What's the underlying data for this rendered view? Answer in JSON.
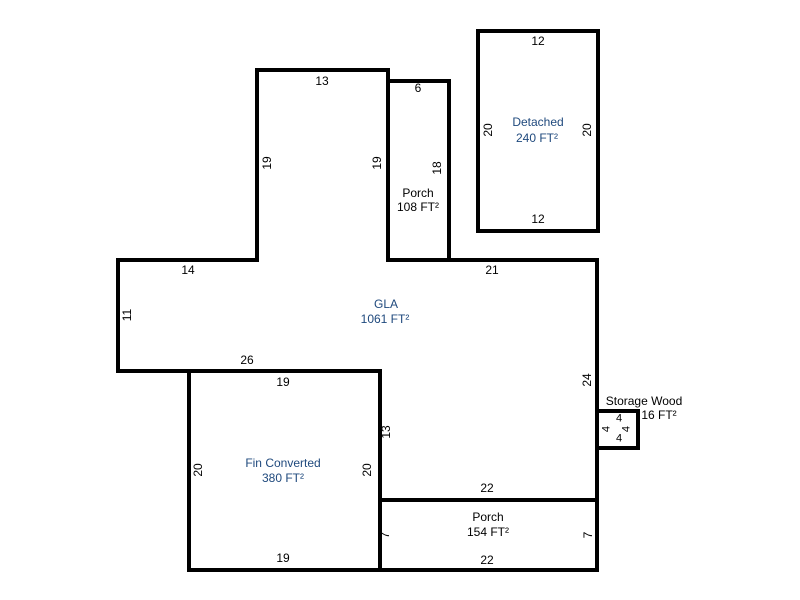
{
  "sketch": {
    "type": "floor-plan",
    "units": "FT",
    "scale_px_per_ft": 10
  },
  "rooms": {
    "gla": {
      "name": "GLA",
      "area": "1061 FT²"
    },
    "porch_top": {
      "name": "Porch",
      "area": "108 FT²"
    },
    "detached": {
      "name": "Detached",
      "area": "240 FT²"
    },
    "fin_converted": {
      "name": "Fin Converted",
      "area": "380 FT²"
    },
    "porch_bottom": {
      "name": "Porch",
      "area": "154 FT²"
    },
    "storage": {
      "name": "Storage Wood",
      "area": "16 FT²"
    }
  },
  "dims": {
    "tower_top": "13",
    "tower_left": "19",
    "tower_right": "19",
    "porch_top_width": "6",
    "porch_top_height": "18",
    "detached_top": "12",
    "detached_bottom": "12",
    "detached_left": "20",
    "detached_right": "20",
    "gla_left_top_width": "14",
    "gla_left_height": "11",
    "gla_right_top_width": "21",
    "gla_right_height": "24",
    "gla_bottom_width": "26",
    "gla_inner_height": "13",
    "fin_top": "19",
    "fin_bottom": "19",
    "fin_left": "20",
    "fin_right": "20",
    "porch_bottom_top": "22",
    "porch_bottom_bottom": "22",
    "porch_bottom_left": "7",
    "porch_bottom_right": "7",
    "storage_top": "4",
    "storage_left": "4",
    "storage_right": "4",
    "storage_bottom": "4"
  },
  "colors": {
    "walls": "#000000",
    "living_area_label": "#1F497D",
    "other_label": "#000000",
    "background": "#ffffff"
  }
}
